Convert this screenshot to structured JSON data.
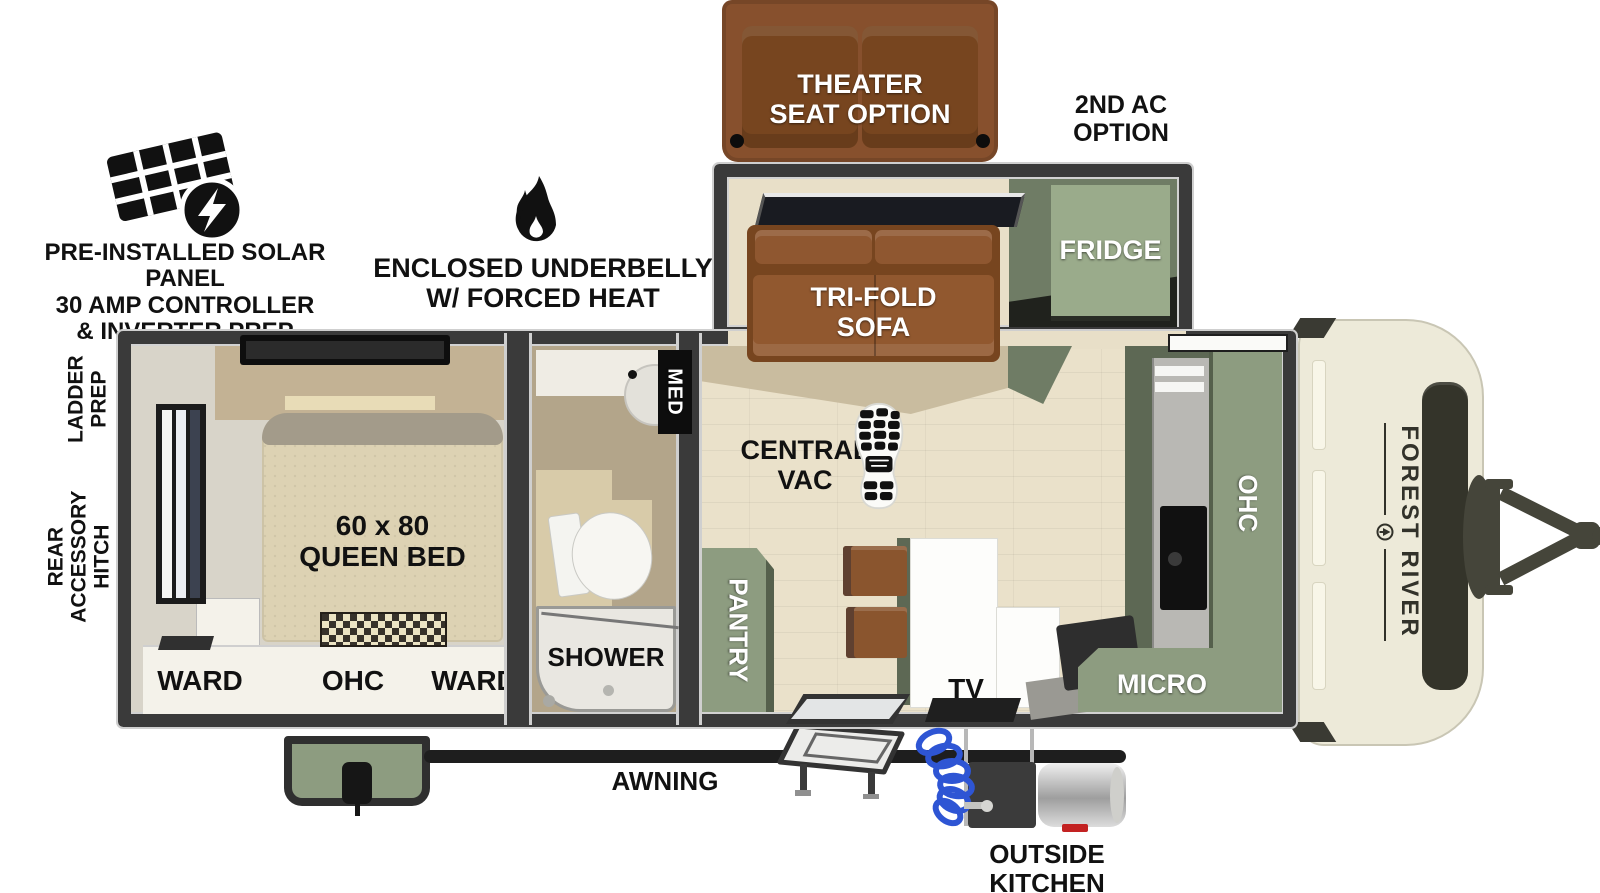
{
  "title": "Forest River travel trailer floorplan",
  "callouts": {
    "theater_seat": "THEATER\nSEAT OPTION",
    "second_ac": "2ND AC\nOPTION",
    "solar": "PRE-INSTALLED SOLAR PANEL\n30 AMP CONTROLLER\n& INVERTER PREP",
    "underbelly": "ENCLOSED UNDERBELLY\nW/ FORCED HEAT",
    "ladder_prep": "LADDER\nPREP",
    "rear_hitch": "REAR\nACCESSORY\nHITCH",
    "awning": "AWNING",
    "outside_kitchen": "OUTSIDE\nKITCHEN"
  },
  "labels": {
    "fridge": "FRIDGE",
    "trifold_sofa": "TRI-FOLD\nSOFA",
    "central_vac": "CENTRAL\nVAC",
    "pantry": "PANTRY",
    "tv": "TV",
    "micro": "MICRO",
    "kitchen_ohc": "OHC",
    "med": "MED",
    "shower": "SHOWER",
    "queen_bed": "60 x 80\nQUEEN BED",
    "ward_left": "WARD",
    "bed_ohc": "OHC",
    "ward_right": "WARD"
  },
  "brand": {
    "name": "FOREST RIVER"
  },
  "colors": {
    "sage": "#8d9c80",
    "sage_dark": "#5d6854",
    "sofa_brown": "#87502d",
    "sofa_brown_dark": "#77451f",
    "cream": "#edead9",
    "olive": "#3b3b2d",
    "wall": "#3a3a3a",
    "floor": "#eae1ca",
    "floor_slide": "#e8dfc8",
    "white_cab": "#f4f2ea",
    "hose_blue": "#2e55d4"
  }
}
